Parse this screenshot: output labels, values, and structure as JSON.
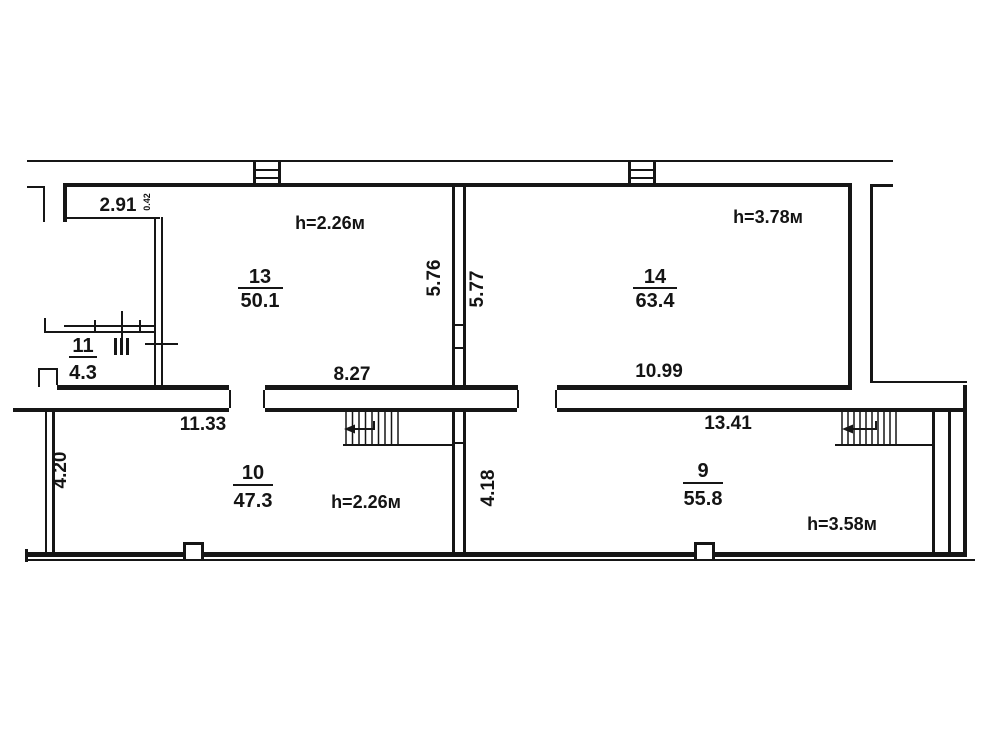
{
  "plan_title": "floor-plan",
  "colors": {
    "line": "#161616",
    "background": "#ffffff"
  },
  "rooms": {
    "r13": {
      "number": "13",
      "area": "50.1",
      "height": "h=2.26м"
    },
    "r14": {
      "number": "14",
      "area": "63.4",
      "height": "h=3.78м"
    },
    "r11": {
      "number": "11",
      "area": "4.3"
    },
    "r10": {
      "number": "10",
      "area": "47.3",
      "height": "h=2.26м"
    },
    "r9": {
      "number": "9",
      "area": "55.8",
      "height": "h=3.58м"
    }
  },
  "dims": {
    "niche_width": "2.91",
    "niche_side": "0.42",
    "room13_bottom": "8.27",
    "room13_side": "5.76",
    "room14_side": "5.77",
    "room14_bottom": "10.99",
    "room10_top": "11.33",
    "room10_side": "4.20",
    "room9_top": "13.41",
    "room9_side": "4.18"
  }
}
